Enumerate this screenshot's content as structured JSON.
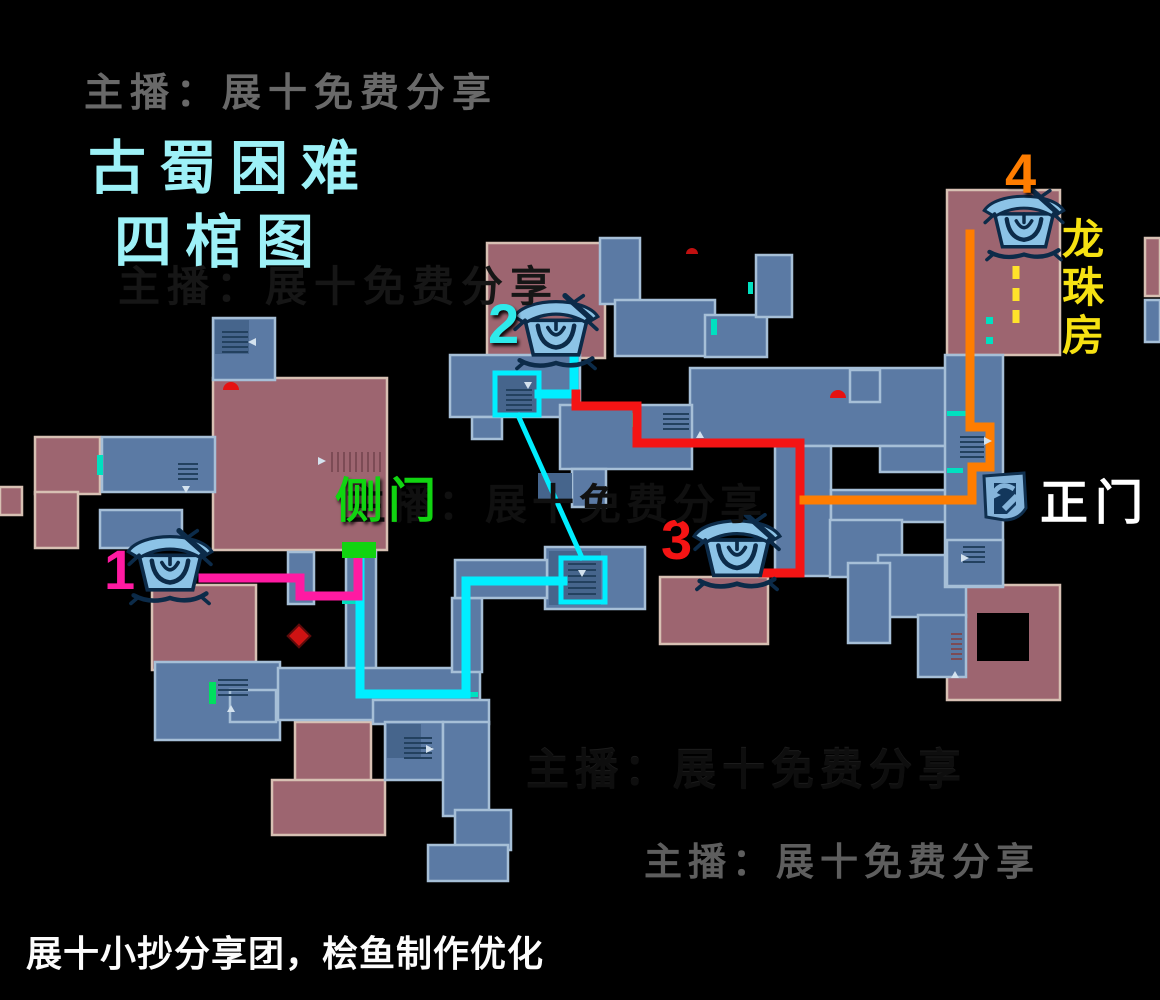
{
  "title": {
    "line1": "古蜀困难",
    "line2": "四棺图"
  },
  "streamer": {
    "text": "主播：展十免费分享"
  },
  "footer": {
    "credit": "展十小抄分享团，桧鱼制作优化"
  },
  "map": {
    "labels": {
      "coffin1": "1",
      "coffin2": "2",
      "coffin3": "3",
      "coffin4": "4",
      "side_door": "侧门",
      "main_door": "正门",
      "dragon_room": "龙珠房"
    },
    "icons": {
      "coffin": "bronze-coffin-icon",
      "door": "main-gate-door-icon"
    }
  },
  "colors": {
    "route_magenta": "#ff1aa2",
    "route_cyan": "#00eeff",
    "route_red": "#f41414",
    "route_orange": "#ff7d00",
    "route_yellow": "#ffe32b",
    "door_green": "#11d411",
    "title_cyan": "#9df1f7",
    "label_yellow": "#f6e112",
    "room_blue": "#5b7aa4",
    "room_blue_border": "#a6bfd7",
    "room_blue_dark": "#46658c",
    "room_pink": "#9d6570",
    "room_pink_border": "#d7c0b3",
    "coffin_light": "#8cc3e6",
    "coffin_dark": "#0c2b49"
  }
}
